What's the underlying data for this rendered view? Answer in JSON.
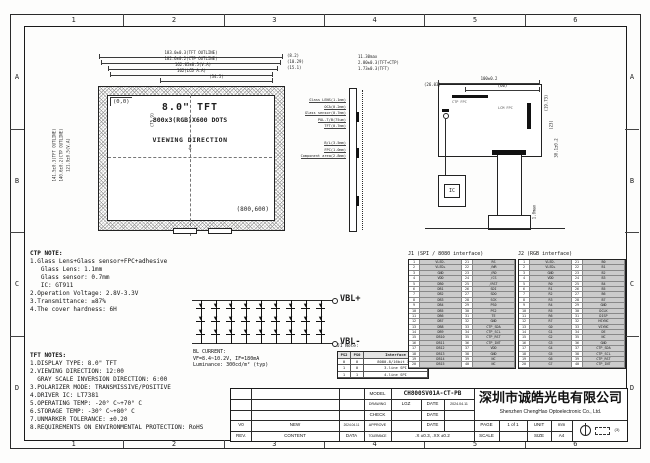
{
  "frame": {
    "top_zones": [
      "1",
      "2",
      "3",
      "4",
      "5",
      "6"
    ],
    "side_zones": [
      "A",
      "B",
      "C",
      "D"
    ]
  },
  "front_view": {
    "origin_label": "(0,0)",
    "size_label": "8.0\" TFT",
    "dots_label": "800x3(RGB)X600 DOTS",
    "viewing_label": "VIEWING DIRECTION",
    "viewing_arrow": "⇩",
    "corner_label": "(800,600)",
    "dims_top": [
      "183.0±0.3(TFT OUTLINE)",
      "182.6±0.2(CTP OUTLINE)",
      "162.05±0.5(V.A)",
      "162(LCD A.A)",
      "(34.5)"
    ],
    "dims_right": [
      "(8.2)",
      "(10.29)",
      "(15.1)"
    ],
    "dims_left": [
      "141.5±0.3(TFT OUTLINE)",
      "140.6±0.2(CTP OUTLINE)",
      "121.9±0.5(V.A)",
      "(75.9)"
    ]
  },
  "side_view": {
    "dims_top": [
      "11.30max",
      "2.80±0.3(TFT+CTP)",
      "1.73±0.3(TFT)"
    ],
    "layers_upper": [
      "Glass LENS(1.1mm)",
      "OCA(0.2mm)",
      "Glass sensor(0.7mm)",
      "POL.T/B(75um)",
      "TFT(0.7mm)"
    ],
    "layers_lower": [
      "B/L(3.5mm)",
      "FPC(1.0mm)",
      "Component area(2.8mm)"
    ]
  },
  "rear_view": {
    "dim_width": "100±0.2",
    "dim_inner": "(60)",
    "dim_left": "(26.03)",
    "dim_right1": "(19.73)",
    "dim_right2": "(23)",
    "dim_right3": "30.1±0.2",
    "dim_bottom": "1.0max",
    "ctp_fpc_label": "CTP FPC",
    "lcm_fpc_label": "LCM FPC",
    "ic_label": "IC"
  },
  "ctp_note": {
    "title": "CTP NOTE:",
    "lines": [
      "1.Glass Lens+Glass sensor+FPC+adhesive",
      "   Glass Lens: 1.1mm",
      "   Glass sensor: 0.7mm",
      "   IC: GT911",
      "2.Operation Voltage: 2.8V-3.3V",
      "3.Transmittance: ≥87%",
      "4.The cover hardness: 6H"
    ]
  },
  "tft_notes": {
    "title": "TFT NOTES:",
    "lines": [
      "1.DISPLAY TYPE: 8.0\" TFT",
      "2.VIEWING DIRECTION: 12:00",
      "  GRAY SCALE INVERSION DIRECTION: 6:00",
      "3.POLARIZER MODE: TRANSMISSIVE/POSITIVE",
      "4.DRIVER IC: LT7381",
      "5.OPERATING TEMP: -20° C~+70° C",
      "6.STORAGE TEMP: -30° C~+80° C",
      "7.UNMARKER TOLERANCE: ±0.20",
      "8.REQUIREMENTS ON ENVIRONMENTAL PROTECTION: RoHS"
    ]
  },
  "backlight": {
    "vbl_plus": "VBL+",
    "vbl_minus": "VBL-",
    "strings": 9,
    "leds_per_string": 3,
    "current_title": "BL CURRENT:",
    "current_lines": [
      "VF=8.4~10.2V, IF=180mA",
      "Luminance: 300cd/m² (typ)"
    ]
  },
  "j1_note": {
    "title": "J1 Note:",
    "headers": [
      "PS2",
      "PS0",
      "Interface"
    ],
    "rows": [
      [
        "0",
        "0",
        "8080-8/16bit I/F"
      ],
      [
        "1",
        "0",
        "3-line SPI"
      ],
      [
        "1",
        "1",
        "4-line SPI"
      ]
    ]
  },
  "j1_table": {
    "title": "J1 (SPI / 8080 interface)",
    "pins": [
      "VLED-",
      "VLED+",
      "GND",
      "VDD",
      "DB0",
      "DB1",
      "DB2",
      "DB3",
      "DB4",
      "DB5",
      "DB6",
      "DB7",
      "DB8",
      "DB9",
      "DB10",
      "DB11",
      "DB12",
      "DB13",
      "DB14",
      "DB15",
      "RS",
      "/WR",
      "/RD",
      "/CS",
      "/RST",
      "SDI",
      "SDO",
      "SCK",
      "PS0",
      "PS2",
      "TE",
      "GND",
      "CTP_SDA",
      "CTP_SCL",
      "CTP_RST",
      "CTP_INT",
      "VDD",
      "GND",
      "NC",
      "NC"
    ]
  },
  "j2_table": {
    "title": "J2 (RGB interface)",
    "pins": [
      "VLED-",
      "VLED+",
      "GND",
      "VDD",
      "R0",
      "R1",
      "R2",
      "R3",
      "R4",
      "R5",
      "R6",
      "R7",
      "G0",
      "G1",
      "G2",
      "G3",
      "G4",
      "G5",
      "G6",
      "G7",
      "B0",
      "B1",
      "B2",
      "B3",
      "B4",
      "B5",
      "B6",
      "B7",
      "GND",
      "DCLK",
      "DISP",
      "HSYNC",
      "VSYNC",
      "DE",
      "NC",
      "GND",
      "CTP_SDA",
      "CTP_SCL",
      "CTP_RST",
      "CTP_INT"
    ]
  },
  "title_block": {
    "model_label": "MODEL",
    "model": "CH800SV01A-CT-PB",
    "drawing_label": "DRAWING",
    "drawing": "LGZ",
    "date_label": "DATE",
    "drawing_date": "2024.04.11",
    "check_label": "CHECK",
    "approve_label": "APPROVE",
    "tolerance_label": "TOLERANCE",
    "tolerance": ".X ±0.3, .XX ±0.2",
    "rev": "V0",
    "rev_content": "NEW",
    "rev_date": "2024.04.11",
    "rev_label": "REV.",
    "content_label": "CONTENT",
    "data_label": "DATA",
    "company_cn": "深圳市诚皓光电有限公司",
    "company_en": "Shenzhen ChengHao Optoelectronic Co., Ltd.",
    "page_label": "PAGE",
    "page": "1 of 1",
    "unit_label": "UNIT",
    "unit": "mm",
    "scale_label": "SCALE",
    "size_label": "SIZE",
    "size": "A4",
    "projection_label": "(3)"
  }
}
